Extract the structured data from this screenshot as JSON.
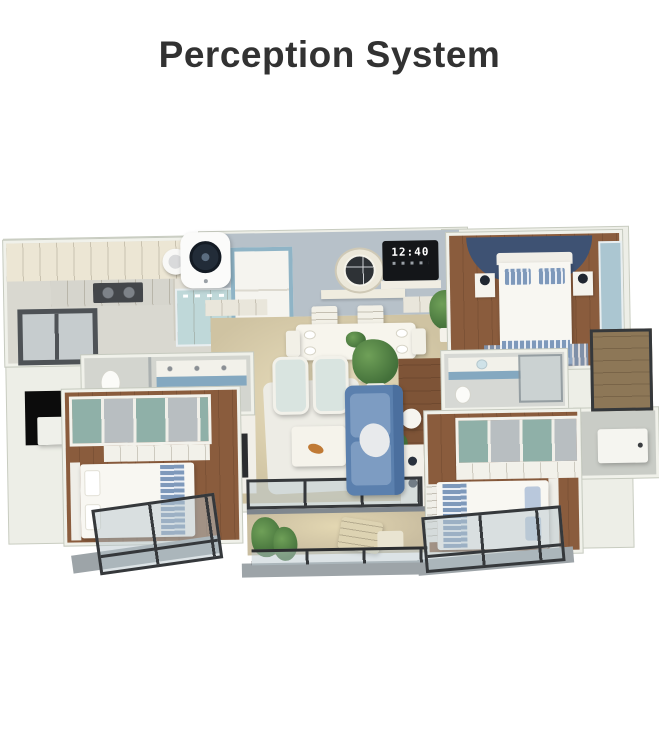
{
  "page": {
    "title": "Perception System"
  },
  "floorplan": {
    "smart_display": {
      "time": "12:40"
    },
    "devices": [
      "security-camera",
      "smart-wall-display",
      "wall-clock"
    ],
    "rooms": [
      "kitchen",
      "entry",
      "dining-area",
      "living-room",
      "hallway",
      "master-bedroom",
      "bedroom-left",
      "bedroom-right",
      "bathroom-left",
      "bathroom-right",
      "balcony-left",
      "balcony-center",
      "balcony-right",
      "utility-balcony"
    ]
  },
  "theme": {
    "title": "#323232",
    "wallblue": "#b7c1c9",
    "navy": "#3e5273",
    "sofa": "#5b80ae",
    "wood": "#8a5c3d",
    "wood-dark": "#7e5437",
    "living": "#cfc3a2",
    "cabinet-blue": "#bfd8d9",
    "door-teal": "#8fb0a8",
    "frame-dark": "#35383b",
    "apron": "#9da4a8"
  }
}
